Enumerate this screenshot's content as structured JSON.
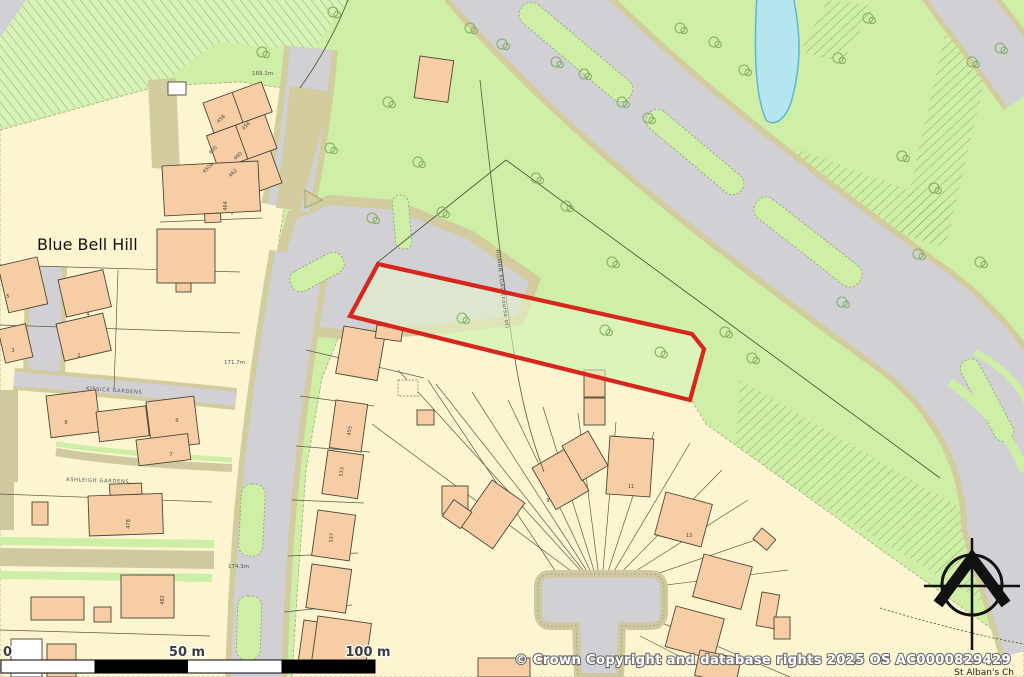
{
  "map": {
    "area_label": "Blue Bell Hill",
    "church_label": "St Alban's Ch",
    "streets": {
      "kissick": "KISSICK GARDENS",
      "ashleigh": "ASHLEIGH GARDENS",
      "roman_road": "ROMAN ROAD (course of)"
    },
    "spot_heights": [
      {
        "text": "169.1m"
      },
      {
        "text": "171.7m"
      },
      {
        "text": "174.3m"
      }
    ],
    "house_numbers": [
      {
        "text": "458"
      },
      {
        "text": "456"
      },
      {
        "text": "450"
      },
      {
        "text": "460"
      },
      {
        "text": "450a"
      },
      {
        "text": "462"
      },
      {
        "text": "464"
      },
      {
        "text": "5"
      },
      {
        "text": "4"
      },
      {
        "text": "3"
      },
      {
        "text": "2"
      },
      {
        "text": "8"
      },
      {
        "text": "9"
      },
      {
        "text": "7"
      },
      {
        "text": "478"
      },
      {
        "text": "482"
      },
      {
        "text": "455"
      },
      {
        "text": "533"
      },
      {
        "text": "537"
      },
      {
        "text": "9"
      },
      {
        "text": "11"
      },
      {
        "text": "13"
      }
    ]
  },
  "footer": {
    "copyright": "© Crown Copyright and database rights 2025 OS AC0000829429",
    "scale_bar": {
      "start": "0",
      "mid": "50 m",
      "end": "100 m"
    }
  },
  "icons": {
    "north_arrow": "north-arrow-icon",
    "tree": "tree-icon"
  },
  "colors": {
    "site_boundary": "#d7261c",
    "residential_plot": "#fdf4d0",
    "building": "#f6cda4",
    "grass": "#cfeea6",
    "grass_light": "#e8f7c9",
    "road": "#d1d1d5",
    "verge": "#d2cc9e",
    "water": "#b5e6f0",
    "scale_bar_black": "#000000",
    "copyright_text": "#ffffff"
  }
}
